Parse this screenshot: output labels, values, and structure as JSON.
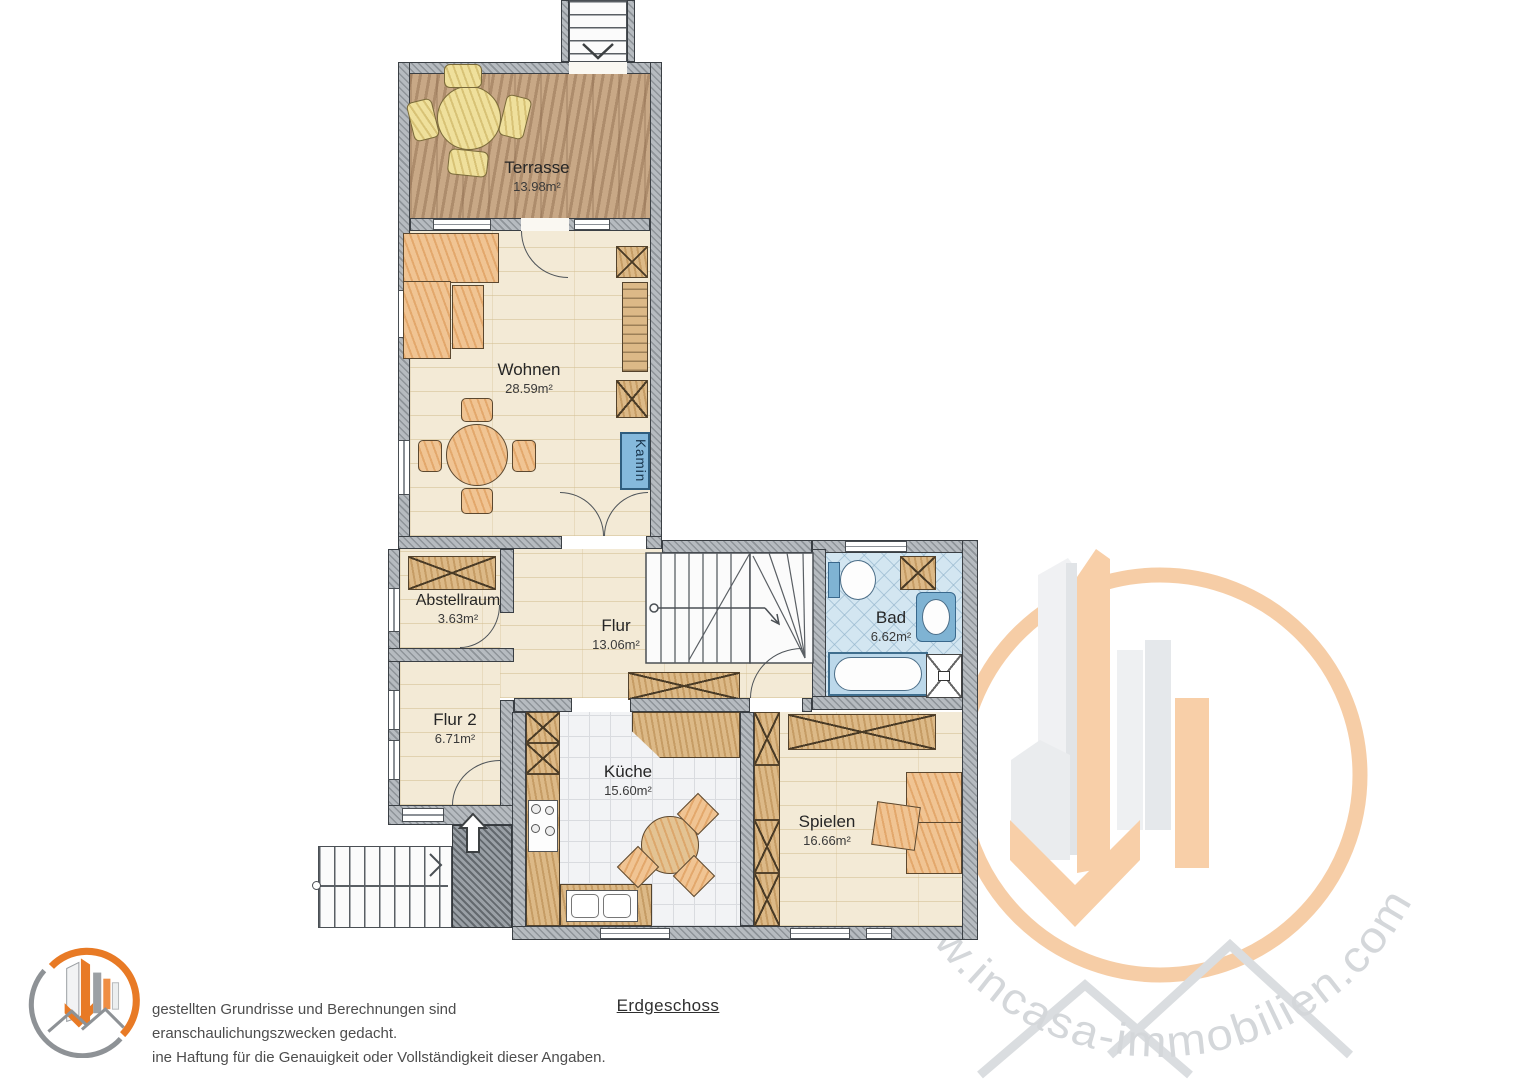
{
  "page": {
    "floor_title": "Erdgeschoss"
  },
  "rooms": [
    {
      "id": "terrasse",
      "name": "Terrasse",
      "area": "13.98m²"
    },
    {
      "id": "wohnen",
      "name": "Wohnen",
      "area": "28.59m²"
    },
    {
      "id": "abstellraum",
      "name": "Abstellraum",
      "area": "3.63m²"
    },
    {
      "id": "flur",
      "name": "Flur",
      "area": "13.06m²"
    },
    {
      "id": "bad",
      "name": "Bad",
      "area": "6.62m²"
    },
    {
      "id": "flur2",
      "name": "Flur 2",
      "area": "6.71m²"
    },
    {
      "id": "kueche",
      "name": "Küche",
      "area": "15.60m²"
    },
    {
      "id": "spielen",
      "name": "Spielen",
      "area": "16.66m²"
    }
  ],
  "annotations": {
    "kamin_label": "Kamin"
  },
  "watermark": {
    "url": "www.incasa-immobilien.com"
  },
  "footer": {
    "disclaimer_line1": "gestellten Grundrisse und Berechnungen sind",
    "disclaimer_line2": "eranschaulichungszwecken gedacht.",
    "disclaimer_line3": "ine Haftung für die Genauigkeit oder Vollständigkeit dieser Angaben."
  },
  "colors": {
    "wall_gray": "#b6bbc0",
    "floor_cream": "#f3ead6",
    "terrace_brown": "#c8a886",
    "bath_blue": "#d3e6f1",
    "furniture_orange": "#f0c493",
    "wood_tan": "#dcb987",
    "kamin_blue": "#85b9dc",
    "logo_orange": "#e87a25",
    "watermark_peach": "#f6cba2"
  }
}
